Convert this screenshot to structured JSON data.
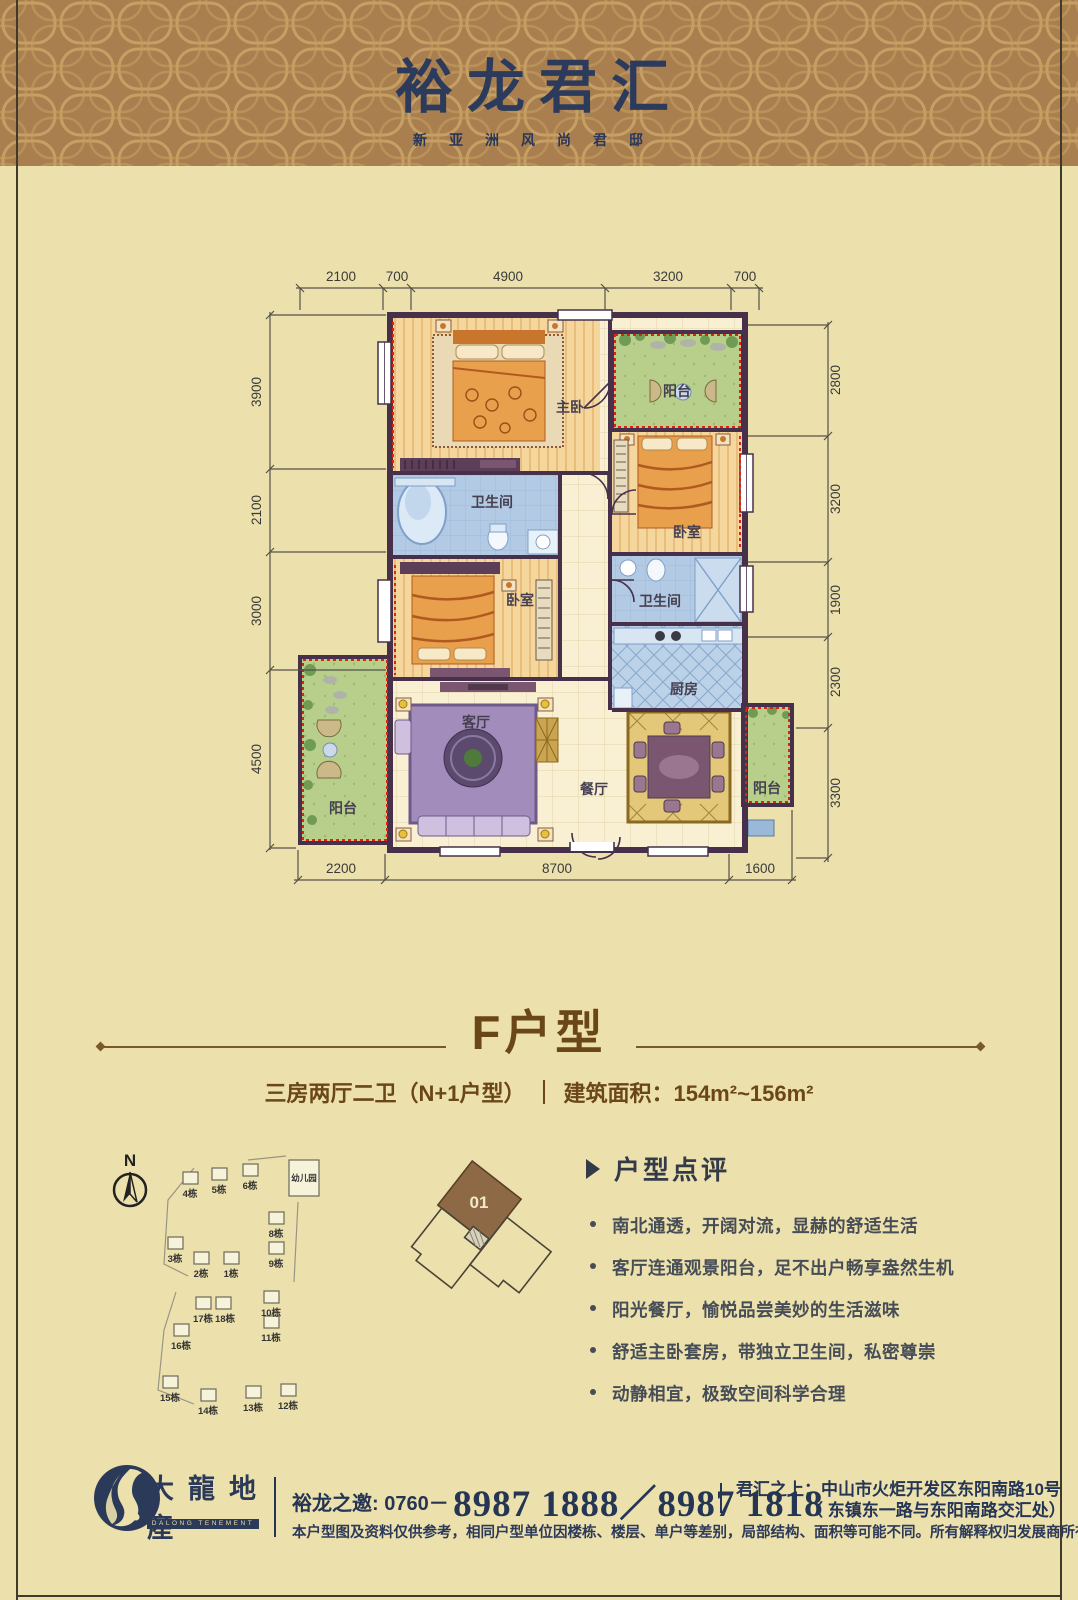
{
  "header": {
    "title": "裕龙君汇",
    "subtitle": "新亚洲风尚君邸"
  },
  "floorplan": {
    "dims_top": [
      "2100",
      "700",
      "4900",
      "3200",
      "700"
    ],
    "dims_left": [
      "3900",
      "2100",
      "3000",
      "4500"
    ],
    "dims_right": [
      "2800",
      "3200",
      "1900",
      "2300",
      "3300"
    ],
    "dims_bottom": [
      "2200",
      "8700",
      "1600"
    ],
    "rooms": {
      "master": "主卧",
      "balcony_top": "阳台",
      "bedroom_right": "卧室",
      "bath_left": "卫生间",
      "bedroom_left": "卧室",
      "bath_right": "卫生间",
      "kitchen": "厨房",
      "living": "客厅",
      "dining": "餐厅",
      "balcony_left": "阳台",
      "balcony_right": "阳台"
    }
  },
  "unit": {
    "name": "F户型",
    "layout": "三房两厅二卫（N+1户型）",
    "area": "建筑面积：154m²~156m²"
  },
  "siteplan": {
    "north": "N",
    "kindergarten": "幼儿园",
    "buildings": [
      "4栋",
      "5栋",
      "6栋",
      "3栋",
      "2栋",
      "1栋",
      "8栋",
      "9栋",
      "17栋",
      "18栋",
      "16栋",
      "10栋",
      "11栋",
      "15栋",
      "14栋",
      "13栋",
      "12栋"
    ]
  },
  "keyplan": {
    "unit": "01"
  },
  "review": {
    "title": "户型点评",
    "points": [
      "南北通透，开阔对流，显赫的舒适生活",
      "客厅连通观景阳台，足不出户畅享盎然生机",
      "阳光餐厅，愉悦品尝美妙的生活滋味",
      "舒适主卧套房，带独立卫生间，私密尊崇",
      "动静相宜，极致空间科学合理"
    ]
  },
  "footer": {
    "brand": "大龍地産",
    "brand_en": "DALONG TENEMENT",
    "invite_label": "裕龙之邀: 0760－",
    "phone": "8987 1888／8987 1818",
    "location_label": "君汇之上：",
    "address1": "中山市火炬开发区东阳南路10号",
    "address2": "（ 东镇东一路与东阳南路交汇处）",
    "disclaimer": "本户型图及资料仅供参考，相同户型单位因楼栋、楼层、单户等差别，局部结构、面积等可能不同。所有解释权归发展商所有"
  }
}
